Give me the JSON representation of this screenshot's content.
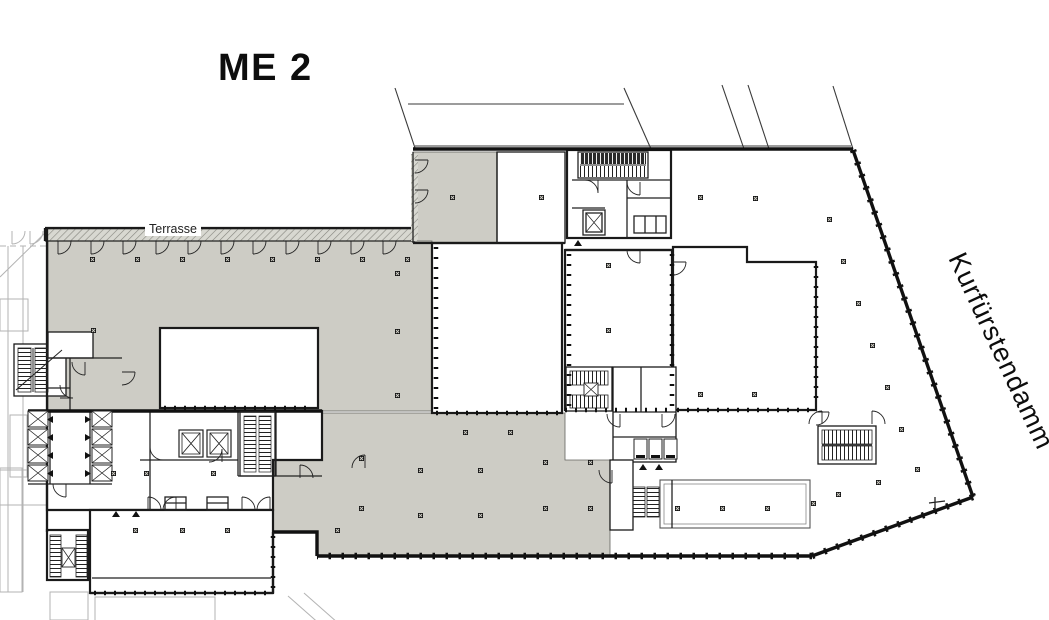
{
  "title": "ME 2",
  "labels": {
    "terrace": "Terrasse",
    "street": "Kurfürstendamm"
  },
  "colors": {
    "shaded_area": "#cdccc5",
    "walls": "#1a1a1a",
    "background": "#ffffff"
  }
}
